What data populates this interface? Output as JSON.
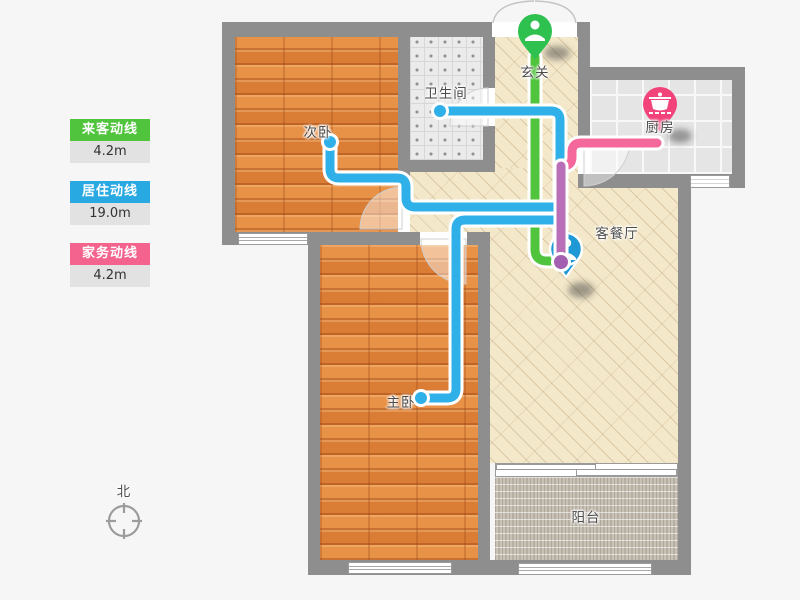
{
  "legend": {
    "items": [
      {
        "label": "来客动线",
        "value": "4.2m",
        "color": "#4fc43c"
      },
      {
        "label": "居住动线",
        "value": "19.0m",
        "color": "#29a9e2"
      },
      {
        "label": "家务动线",
        "value": "4.2m",
        "color": "#f4638e"
      }
    ]
  },
  "rooms": {
    "entry": "玄关",
    "bathroom": "卫生间",
    "secondary_bedroom": "次卧",
    "kitchen": "厨房",
    "living_dining": "客餐厅",
    "master_bedroom": "主卧",
    "balcony": "阳台"
  },
  "compass": {
    "north": "北"
  },
  "route_colors": {
    "visitor": "#4fc43c",
    "resident": "#2fb0e8",
    "chore": "#f4689c",
    "overlap": "#b86fb8",
    "overlap_cap": "#a55fb0"
  },
  "marker_colors": {
    "entry_pin": "#2ec150",
    "kitchen_pin": "#f2447b",
    "person": "#1f98d6"
  }
}
